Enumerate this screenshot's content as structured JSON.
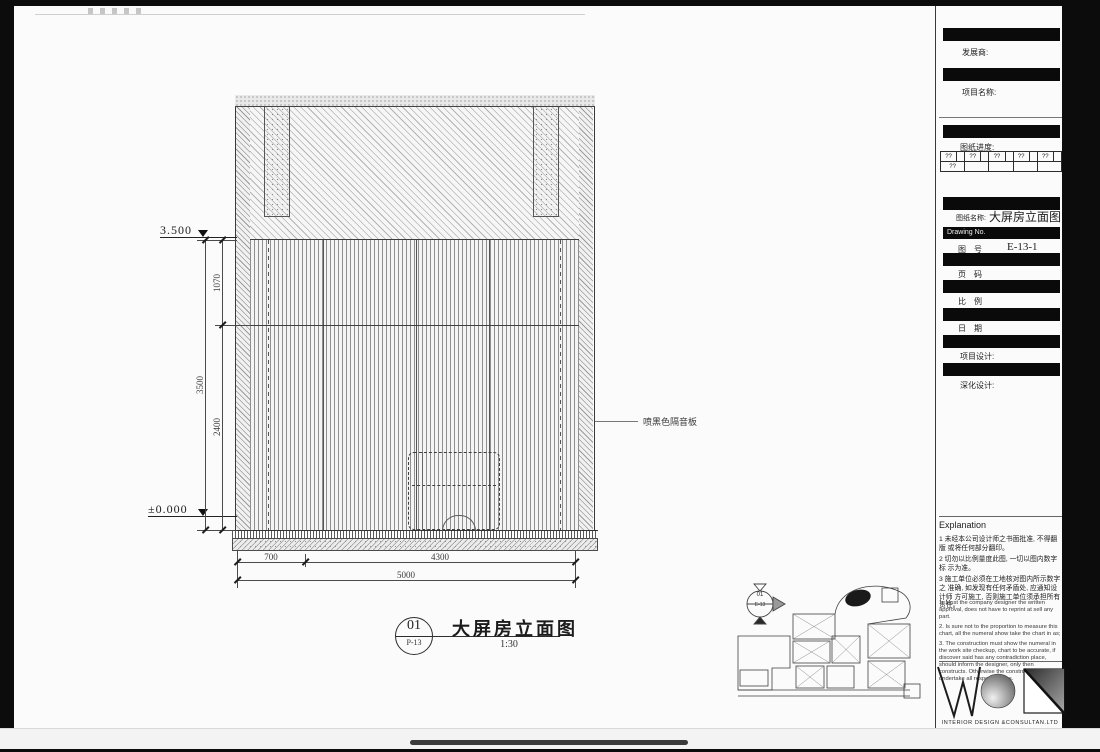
{
  "elevation": {
    "level_top": "3.500",
    "level_bottom": "±0.000",
    "dim_total_height": "3500",
    "dim_upper": "1070",
    "dim_lower": "2400",
    "dim_left": "700",
    "dim_right": "4300",
    "dim_total_width": "5000",
    "leader_label": "喷黑色隔音板"
  },
  "view_title": {
    "number": "01",
    "sheet_ref": "P-13",
    "name": "大屏房立面图",
    "scale": "1:30"
  },
  "key_plan": {
    "marker_number": "01",
    "marker_sheet": "E-13"
  },
  "title_block": {
    "developer_label": "发展商:",
    "project_name_label": "项目名称:",
    "progress_label": "图纸进度:",
    "revision_table": {
      "r1": [
        "??",
        "",
        "??",
        "",
        "??",
        "",
        "??",
        "",
        "??",
        ""
      ],
      "r2": [
        "??",
        "",
        "",
        "",
        ""
      ]
    },
    "drawing_name_label": "图纸名称:",
    "drawing_name": "大屏房立面图",
    "drawing_no_header": "Drawing No.",
    "drawing_no_label": "图　号",
    "drawing_no_value": "E-13-1",
    "page_label": "页　码",
    "scale_label": "比　例",
    "date_label": "日　期",
    "project_design_label": "项目设计:",
    "detail_design_label": "深化设计:"
  },
  "explanation": {
    "title": "Explanation",
    "notes_cn": [
      "1 未经本公司设计师之书面批准, 不得翻版 或将任何部分翻印。",
      "2 切勿以比例量度此图, 一切以图内数字标 示为准。",
      "3 施工单位必须在工地核对图内所示数字之 准确, 如发现有任何矛盾处, 应通知设计师 方可施工, 否则施工单位须承担所有责任。"
    ],
    "notes_en": [
      "1. Must the company designer the written approval, does not have to reprint at sell any part.",
      "2. Is sure not to the proportion to measure this chart, all the numeral show take the chart in as;",
      "3. The construction must show the numeral in the work site checkup, chart to be accurate, if discover said has any contradiction place, should inform the designer, only then constructs. Otherwise the construction must undertake all responsibilities."
    ]
  },
  "logo": {
    "caption": "INTERIOR DESIGN &CONSULTAN.LTD"
  }
}
